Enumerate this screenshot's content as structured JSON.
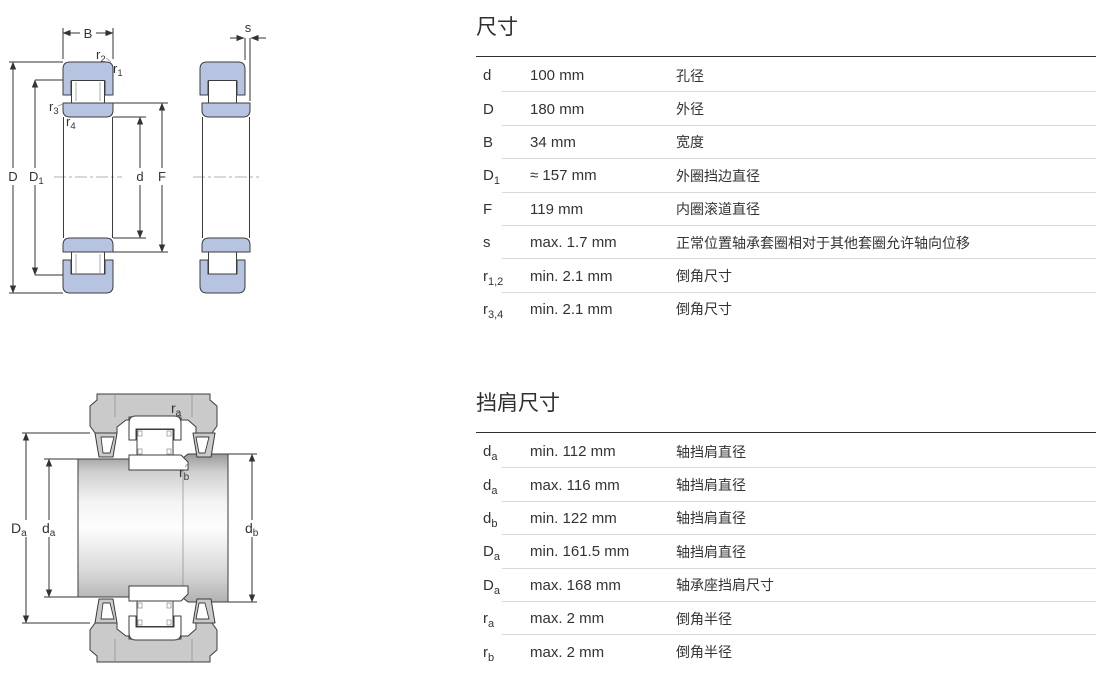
{
  "colors": {
    "accent_blue": "#b6c3e1",
    "housing_gray": "#cacaca",
    "line": "#3c3c3c",
    "text": "#333333",
    "separator": "#d9d9d9"
  },
  "top_diagram": {
    "labels": {
      "B": {
        "base": "B",
        "sub": ""
      },
      "r2": {
        "base": "r",
        "sub": "2"
      },
      "r1": {
        "base": "r",
        "sub": "1"
      },
      "r3": {
        "base": "r",
        "sub": "3"
      },
      "r4": {
        "base": "r",
        "sub": "4"
      },
      "D": {
        "base": "D",
        "sub": ""
      },
      "D1": {
        "base": "D",
        "sub": "1"
      },
      "d": {
        "base": "d",
        "sub": ""
      },
      "F": {
        "base": "F",
        "sub": ""
      },
      "s": {
        "base": "s",
        "sub": ""
      }
    }
  },
  "bottom_diagram": {
    "labels": {
      "Da": {
        "base": "D",
        "sub": "a"
      },
      "da": {
        "base": "d",
        "sub": "a"
      },
      "db": {
        "base": "d",
        "sub": "b"
      },
      "ra": {
        "base": "r",
        "sub": "a"
      },
      "rb": {
        "base": "r",
        "sub": "b"
      }
    }
  },
  "dimensions_table": {
    "title": "尺寸",
    "rows": [
      {
        "sym": "d",
        "sub": "",
        "value": "100 mm",
        "desc": "孔径"
      },
      {
        "sym": "D",
        "sub": "",
        "value": "180 mm",
        "desc": "外径"
      },
      {
        "sym": "B",
        "sub": "",
        "value": "34 mm",
        "desc": "宽度"
      },
      {
        "sym": "D",
        "sub": "1",
        "value": "≈ 157 mm",
        "desc": "外圈挡边直径"
      },
      {
        "sym": "F",
        "sub": "",
        "value": "119 mm",
        "desc": "内圈滚道直径"
      },
      {
        "sym": "s",
        "sub": "",
        "value": "max. 1.7 mm",
        "desc": "正常位置轴承套圈相对于其他套圈允许轴向位移"
      },
      {
        "sym": "r",
        "sub": "1,2",
        "value": "min. 2.1 mm",
        "desc": "倒角尺寸"
      },
      {
        "sym": "r",
        "sub": "3,4",
        "value": "min. 2.1 mm",
        "desc": "倒角尺寸"
      }
    ]
  },
  "abutment_table": {
    "title": "挡肩尺寸",
    "rows": [
      {
        "sym": "d",
        "sub": "a",
        "value": "min. 112 mm",
        "desc": "轴挡肩直径"
      },
      {
        "sym": "d",
        "sub": "a",
        "value": "max. 116 mm",
        "desc": "轴挡肩直径"
      },
      {
        "sym": "d",
        "sub": "b",
        "value": "min. 122 mm",
        "desc": "轴挡肩直径"
      },
      {
        "sym": "D",
        "sub": "a",
        "value": "min. 161.5 mm",
        "desc": "轴挡肩直径"
      },
      {
        "sym": "D",
        "sub": "a",
        "value": "max. 168 mm",
        "desc": "轴承座挡肩尺寸"
      },
      {
        "sym": "r",
        "sub": "a",
        "value": "max. 2 mm",
        "desc": "倒角半径"
      },
      {
        "sym": "r",
        "sub": "b",
        "value": "max. 2 mm",
        "desc": "倒角半径"
      }
    ]
  }
}
